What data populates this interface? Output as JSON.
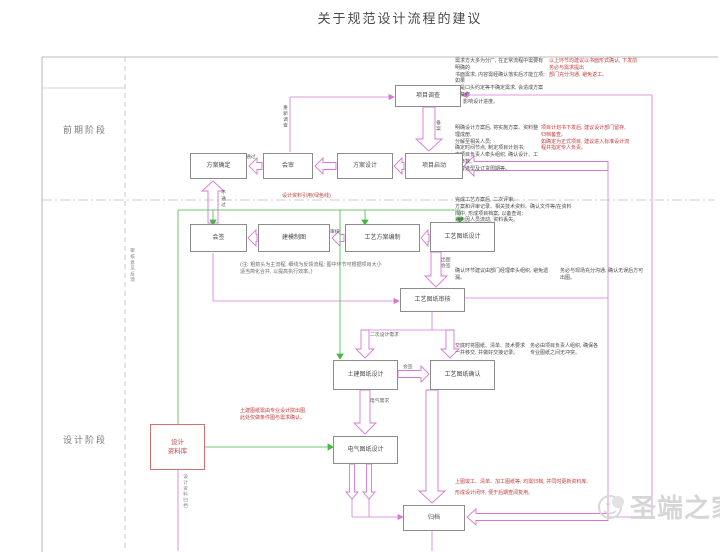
{
  "title": "关于规范设计流程的建议",
  "phases": {
    "early": "前期阶段",
    "design": "设计阶段"
  },
  "boxes": {
    "survey": "项目调查",
    "kickoff": "项目启动",
    "scheme_design": "方案设计",
    "joint_review": "会审",
    "scheme_confirm": "方案确定",
    "countersign": "会签",
    "modeling": "建模制图",
    "process_plan": "工艺方案编制",
    "process_drawing": "工艺图纸设计",
    "drawing_review": "工艺图纸审核",
    "civil_drawing": "土建图纸设计",
    "drawing_confirm": "工艺图纸确认",
    "electrical_drawing": "电气图纸设计",
    "library": "设计\n资料库",
    "archive": "归档"
  },
  "arrow_labels": {
    "record": "备案",
    "resurvey": "重新调查",
    "pass": "通过",
    "fail": "不通过",
    "review": "审核",
    "plot_sign": "出图\n会签",
    "secondary_need": "二次设计需求",
    "countersign2": "会签",
    "elec_need": "电气需求",
    "archive_flow": "设计资料归档",
    "feedback_flow": "审核意见反馈"
  },
  "annotations": {
    "top_black": "需求方大多为分厂, 在正常流程中需要有明确的\n书面需求, 内容需经确认落实后才能立项; 如果\n只是口头约定等不确定需求, 会造成方案反复修\n改, 影响设计进度。",
    "top_red": "以上环节均建议以书面形式确认, 下发前务必与需求提出\n部门充分沟通, 避免返工。",
    "kickoff_black": "明确设计方案后, 将实施方案、资料整理成册,\n分解至相关人员;\n确定时间节点, 制定项目计划书;\n由项目负责人牵头组织, 确认设计、工艺参数、\n设备选型及订货周期等。",
    "kickoff_red": "项目计划书下发后, 建议设计部门留存,\n归档备查。\n如确定为正式项目, 建议进入标准设计流\n程并指定专人负责。",
    "plan_black": "完成工艺方案后, 二次评审;\n方案和评审记录、相关技术资料、确认文件等/在资料\n库中, 形成项目档案, 以备查询;\n避免因人员流动, 资料丢失。",
    "note_gray": "(注: 粗箭头为主流程, 细线为反馈流程; 图中环节可根据项目大小\n适当简化合并, 以提高执行效率。)",
    "confirm_black": "确认环节建议由部门经理牵头组织, 避免遗漏。",
    "confirm_black2": "务必与现场充分沟通, 确认无误后方可出图。",
    "handover_black": "交底时将图纸、清单、技术要求\n一并移交, 并做好交接记录。",
    "handover_black2": "务必由项目负责人组织, 确保各\n专业图纸之间无冲突。",
    "green_red": "设计资料引用(绿色线)",
    "civil_red": "土建图纸需由专业设计院出图,\n此处仅做条件图与需求确认。",
    "archive_red": "上图竣工、清单、加工图纸等, 均需归档, 并同时更新资料库,\n形成设计闭环, 便于后期查阅复用。"
  },
  "watermark": {
    "text": "圣端之家"
  },
  "colors": {
    "flow": "#d678d6",
    "reference": "#44b944",
    "alert": "#c63a3a"
  }
}
